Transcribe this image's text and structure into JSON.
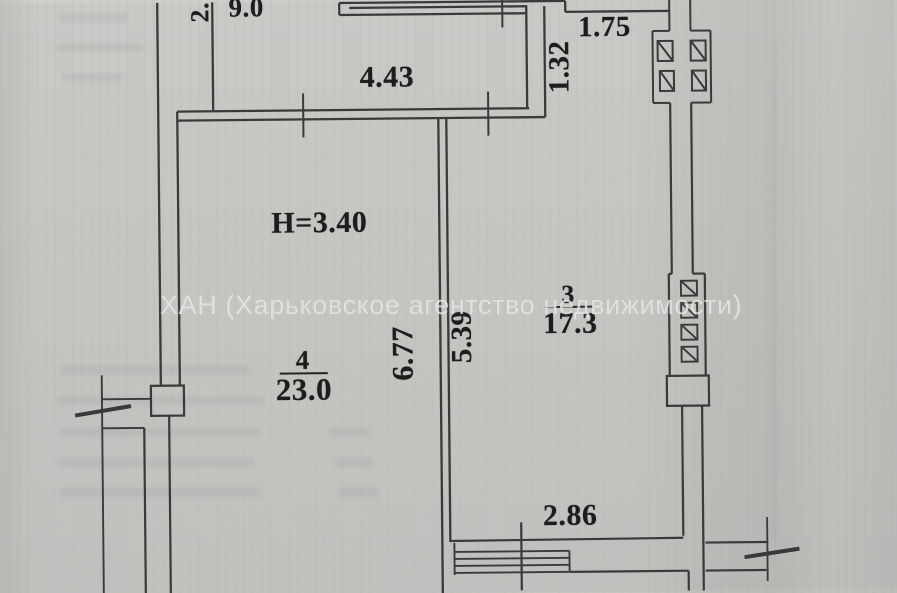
{
  "document": {
    "watermark": "ХАН (Харьковское агентство недвижимости)"
  },
  "plan": {
    "ceiling_height_label": "H=3.40",
    "rooms": [
      {
        "number": "3",
        "area": "17.3"
      },
      {
        "number": "4",
        "area": "23.0"
      }
    ],
    "dimensions": {
      "top_left_vertical": "2.",
      "top_room_width": "9.0",
      "room4_top_width": "4.43",
      "niche_width": "1.75",
      "niche_depth": "1.32",
      "room4_length": "6.77",
      "room3_length": "5.39",
      "window_wall_width": "2.86"
    }
  }
}
